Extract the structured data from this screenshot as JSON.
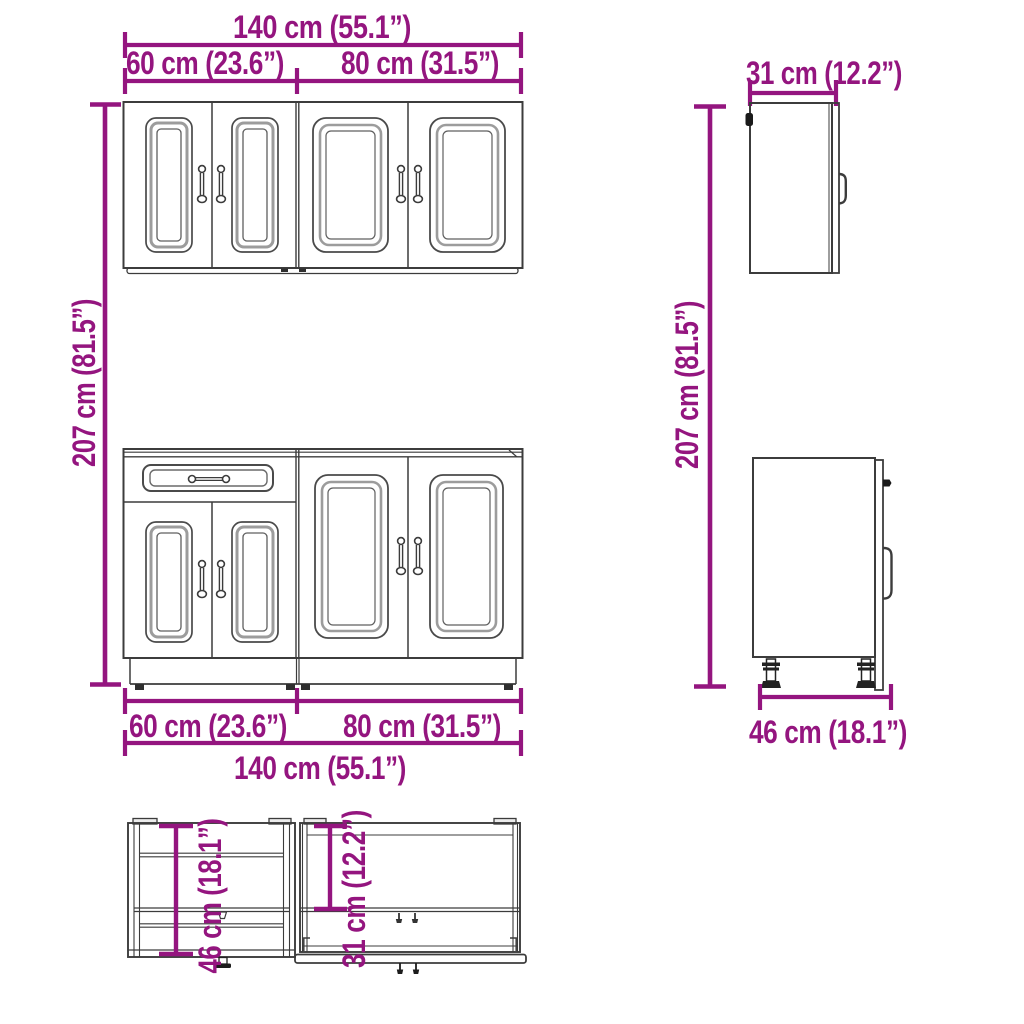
{
  "page": {
    "type": "furniture-dimension-diagram",
    "subject": "kitchen cabinet set (wall cabinets and base cabinets)",
    "background": "#ffffff"
  },
  "colors": {
    "dimension_accent": "#94157F",
    "drawing_outline": "#3C3C3C",
    "panel_frame_gray": "#9C9C9C"
  },
  "labels": {
    "front": {
      "top_total": "140 cm (55.1”)",
      "top_left": "60 cm (23.6”)",
      "top_right": "80 cm (31.5”)",
      "bottom_left": "60 cm (23.6”)",
      "bottom_right": "80 cm (31.5”)",
      "bottom_total": "140 cm (55.1”)",
      "height_left": "207 cm (81.5”)",
      "height_right": "207 cm (81.5”)"
    },
    "side": {
      "wall_cabinet_depth": "31 cm (12.2”)",
      "base_cabinet_depth": "46 cm (18.1”)"
    },
    "topview": {
      "base_cabinet_depth": "46 cm (18.1”)",
      "wall_cabinet_depth": "31 cm (12.2”)"
    }
  },
  "measurements": {
    "total_width": {
      "cm": 140,
      "inches": 55.1
    },
    "left_section_width": {
      "cm": 60,
      "inches": 23.6
    },
    "right_section_width": {
      "cm": 80,
      "inches": 31.5
    },
    "total_height": {
      "cm": 207,
      "inches": 81.5
    },
    "wall_cabinet_depth": {
      "cm": 31,
      "inches": 12.2
    },
    "base_cabinet_depth": {
      "cm": 46,
      "inches": 18.1
    }
  }
}
